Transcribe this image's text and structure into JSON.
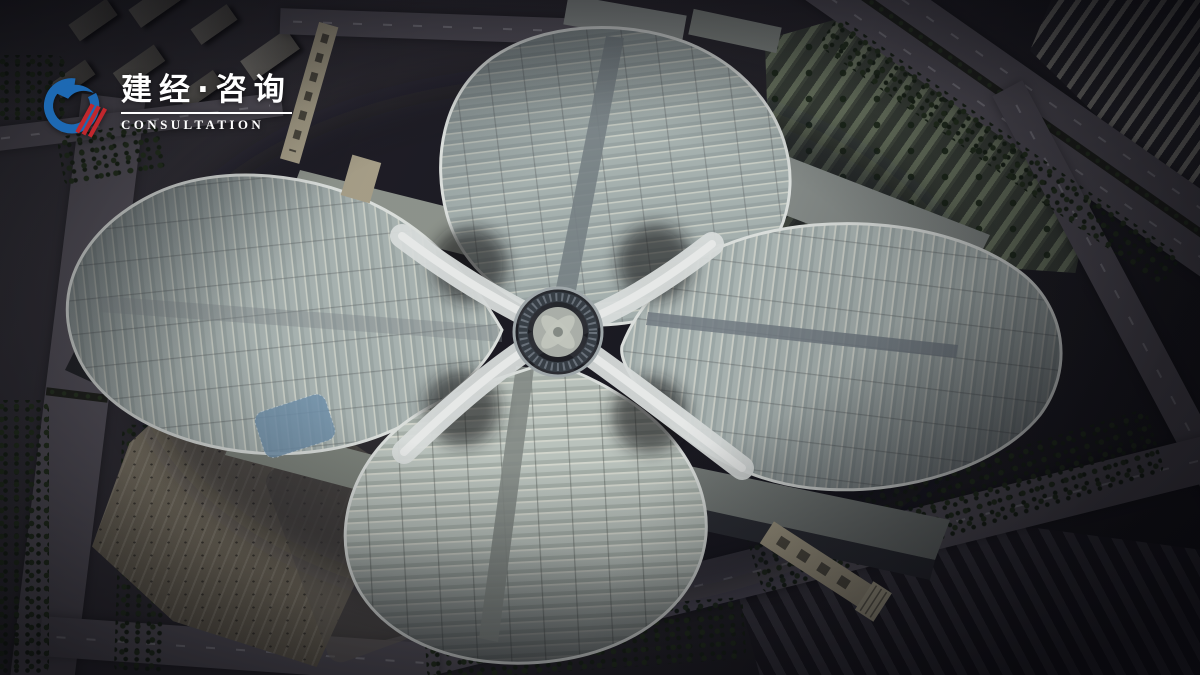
{
  "logo": {
    "brand_cn": "建经·咨询",
    "brand_en": "CONSULTATION",
    "icon_name": "swoosh-circle-logo-icon",
    "colors": {
      "blue": "#1d69b3",
      "red": "#c1272d",
      "text": "#ffffff"
    }
  },
  "scene": {
    "name": "exhibition-center-aerial-rendering",
    "description": "Aerial 3D rendering of a four-hall clover-shaped convention and exhibition center at dusk, with a central circular atrium, white ribbon roofs, entrance plaza, tree-lined boulevards, parking lots and surrounding city blocks",
    "landmarks": [
      "north-hall-roof",
      "west-hall-roof",
      "east-hall-roof",
      "south-hall-roof",
      "central-atrium-hub",
      "white-ribbon-roofs",
      "entrance-plaza",
      "pedestrian-bridge",
      "boulevard",
      "parking-lot",
      "warehouse-rows",
      "depot-rows",
      "city-blocks",
      "tree-clusters"
    ],
    "palette": {
      "roof_panel": "#bcc7c3",
      "roof_seam": "#d8dcd2",
      "roof_spine": "#7e888c",
      "ribbon_white": "#eef1ef",
      "ground_dark": "#27252b",
      "road_gray": "#5e5a63",
      "tree_green": "#22301f",
      "plaza_beige": "#a89d83",
      "glass_dark": "#2e3036"
    }
  }
}
